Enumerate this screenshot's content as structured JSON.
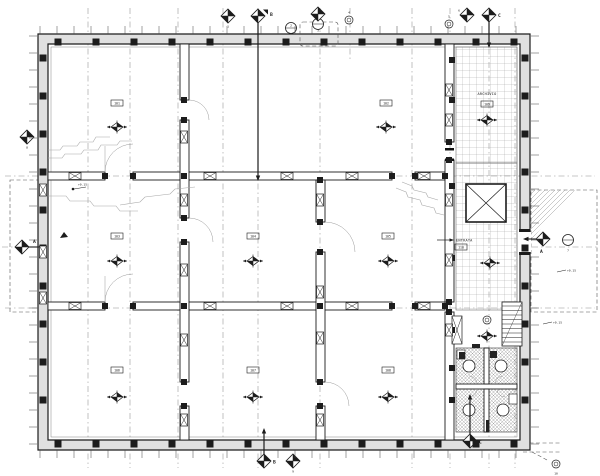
{
  "meta": {
    "kind": "architectural floor plan, scanned black-and-white blueprint",
    "paper_color": "#ffffff",
    "ink_color": "#1c1c1c"
  },
  "rooms": [
    {
      "id": "northwest-hall",
      "number": "101"
    },
    {
      "id": "north-hall",
      "number": "102"
    },
    {
      "id": "west-hall",
      "number": "103"
    },
    {
      "id": "center-hall",
      "number": "104"
    },
    {
      "id": "east-hall",
      "number": "105"
    },
    {
      "id": "southwest-hall",
      "number": "106"
    },
    {
      "id": "south-hall",
      "number": "107"
    },
    {
      "id": "southeast-hall",
      "number": "108"
    },
    {
      "id": "archive-room",
      "number": "109",
      "name": "ARCHIVIO"
    },
    {
      "id": "entry-corridor",
      "number": "110",
      "name": "ENTRATA"
    }
  ],
  "section_markers": {
    "a_left": "A",
    "a_right": "A",
    "b_top": "B",
    "b_bottom": "B",
    "c_top": "C",
    "c_bottom": "C"
  },
  "grid_bubbles": [
    "1",
    "2",
    "3",
    "4",
    "5",
    "6",
    "7",
    "8",
    "9",
    "10"
  ],
  "spot_levels": [
    "+0.15",
    "+0.15",
    "+0.15"
  ]
}
